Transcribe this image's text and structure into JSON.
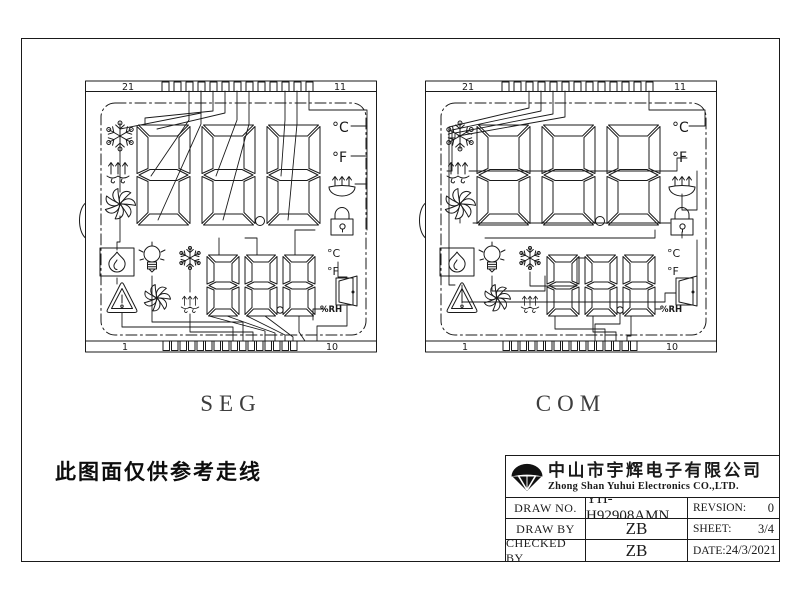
{
  "page": {
    "note": "此图面仅供参考走线",
    "ink": "#1a1a1a",
    "background": "#ffffff"
  },
  "panels": [
    {
      "id": "seg",
      "label": "SEG",
      "pins": {
        "top_left": "21",
        "top_right": "11",
        "bottom_left": "1",
        "bottom_right": "10"
      },
      "large_digits": "888",
      "small_digits": "888",
      "units": {
        "celsius_top": "°C",
        "fahrenheit_top": "°F",
        "celsius_bottom": "°C",
        "fahrenheit_bottom": "°F",
        "humidity": "%RH"
      },
      "icons": [
        "snowflake-icon",
        "defrost-icon",
        "fan-icon",
        "steam-dish-icon",
        "lock-icon",
        "flame-icon",
        "bulb-icon",
        "small-snowflake-icon",
        "warning-triangle-icon",
        "small-fan-icon",
        "small-defrost-icon",
        "door-icon"
      ]
    },
    {
      "id": "com",
      "label": "COM",
      "pins": {
        "top_left": "21",
        "top_right": "11",
        "bottom_left": "1",
        "bottom_right": "10"
      },
      "large_digits": "888",
      "small_digits": "888",
      "units": {
        "celsius_top": "°C",
        "fahrenheit_top": "°F",
        "celsius_bottom": "°C",
        "fahrenheit_bottom": "°F",
        "humidity": "%RH"
      },
      "icons": [
        "snowflake-icon",
        "defrost-icon",
        "fan-icon",
        "steam-dish-icon",
        "lock-icon",
        "flame-icon",
        "bulb-icon",
        "small-snowflake-icon",
        "warning-triangle-icon",
        "small-fan-icon",
        "small-defrost-icon",
        "door-icon"
      ]
    }
  ],
  "title_block": {
    "company_cn": "中山市宇辉电子有限公司",
    "company_en": "Zhong Shan Yuhui Electronics CO.,LTD.",
    "rows": [
      {
        "label": "DRAW NO.",
        "value": "YH-H92908AMN",
        "right_label": "REVSION:",
        "right_value": "0"
      },
      {
        "label": "DRAW BY",
        "value": "ZB",
        "right_label": "SHEET:",
        "right_value": "3/4"
      },
      {
        "label": "CHECKED BY",
        "value": "ZB",
        "right_label": "DATE:",
        "right_value": "24/3/2021"
      }
    ]
  }
}
